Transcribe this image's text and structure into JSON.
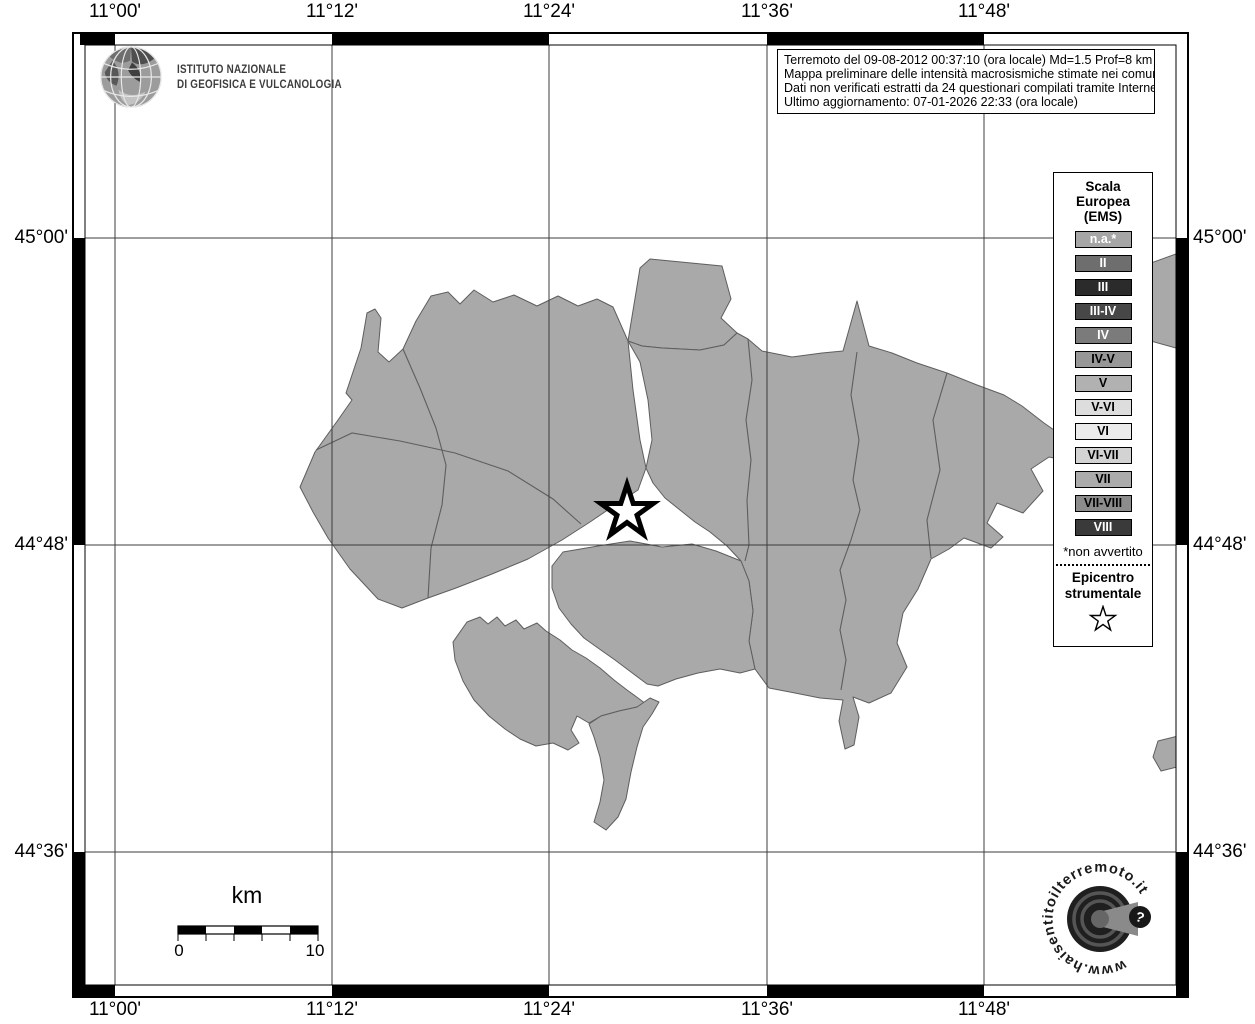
{
  "branding": {
    "ingv_logo": {
      "icon": "ingv-globe-icon",
      "line1": "ISTITUTO NAZIONALE",
      "line2": "DI GEOFISICA E VULCANOLOGIA"
    }
  },
  "info_box": {
    "lines": [
      "Terremoto del 09-08-2012 00:37:10 (ora locale) Md=1.5 Prof=8 km",
      "Mappa preliminare delle intensità macrosismiche stimate nei comuni",
      "Dati non verificati estratti da 24 questionari compilati tramite Internet.",
      "Ultimo aggiornamento: 07-01-2026 22:33 (ora locale)"
    ]
  },
  "axes": {
    "lon_labels": [
      "11°00'",
      "11°12'",
      "11°24'",
      "11°36'",
      "11°48'"
    ],
    "lat_labels": [
      "45°00'",
      "44°48'",
      "44°36'"
    ]
  },
  "legend": {
    "title_lines": [
      "Scala",
      "Europea",
      "(EMS)"
    ],
    "items": [
      {
        "label": "n.a.*",
        "color": "#a6a6a6",
        "text_color": "#ffffff"
      },
      {
        "label": "II",
        "color": "#6e6e6e",
        "text_color": "#ffffff"
      },
      {
        "label": "III",
        "color": "#2b2b2b",
        "text_color": "#ffffff"
      },
      {
        "label": "III-IV",
        "color": "#474747",
        "text_color": "#ffffff"
      },
      {
        "label": "IV",
        "color": "#7b7b7b",
        "text_color": "#ffffff"
      },
      {
        "label": "IV-V",
        "color": "#979797",
        "text_color": "#000000"
      },
      {
        "label": "V",
        "color": "#b1b1b1",
        "text_color": "#000000"
      },
      {
        "label": "V-VI",
        "color": "#dddddd",
        "text_color": "#000000"
      },
      {
        "label": "VI",
        "color": "#ebebeb",
        "text_color": "#000000"
      },
      {
        "label": "VI-VII",
        "color": "#d3d3d3",
        "text_color": "#000000"
      },
      {
        "label": "VII",
        "color": "#ababab",
        "text_color": "#000000"
      },
      {
        "label": "VII-VIII",
        "color": "#8c8c8c",
        "text_color": "#000000"
      },
      {
        "label": "VIII",
        "color": "#3a3a3a",
        "text_color": "#ffffff"
      }
    ],
    "footnote": "*non avvertito",
    "epicenter_label_lines": [
      "Epicentro",
      "strumentale"
    ],
    "epicenter_symbol": "star-icon"
  },
  "scale_bar": {
    "unit_label": "km",
    "start_label": "0",
    "end_label": "10"
  },
  "watermark": {
    "url_text": "www.haisentitoilterremoto.it",
    "question_mark": "?"
  },
  "map": {
    "municipality_fill": "#a9a9a9",
    "municipality_boundary": "#5e5e5e",
    "gridline_color": "#3c3c3c",
    "epicenter": {
      "symbol": "star",
      "fill": "#ffffff",
      "outline": "#000000"
    }
  }
}
